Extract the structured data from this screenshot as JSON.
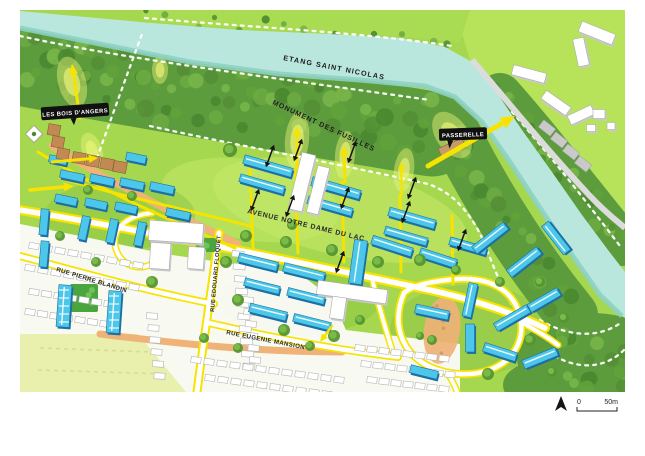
{
  "labels": {
    "lake": "ETANG SAINT NICOLAS",
    "les_bois": "LES BOIS D'ANGERS",
    "monument": "MONUMENT DES FUSILLES",
    "passerelle": "PASSERELLE",
    "avenue": "AVENUE NOTRE DAME DU LAC",
    "rue_blandin": "RUE PIERRE BLANDIN",
    "rue_floquet": "RUE EDOUARD FLOQUET",
    "rue_mansion": "RUE EUGENIE MANSION"
  },
  "scale_bar": {
    "start": "0",
    "end": "50m"
  },
  "icons": {
    "north_arrow": "north-arrow-icon",
    "marker": "map-marker-icon"
  },
  "colors": {
    "water": "#b9e7dd",
    "water_edge": "#8ed2c3",
    "forest": "#5d9c3d",
    "forest_dark": "#4a8830",
    "forest_light": "#78b548",
    "lawn": "#a6d84f",
    "lawn_light": "#c6ea6d",
    "lawn_dark": "#86bf3f",
    "shore": "#a9dc52",
    "road_yellow": "#f6e400",
    "road_white": "#ffffff",
    "path_orange": "#efb277",
    "building_blue": "#4cc7e9",
    "building_blue_dark": "#1d6fa5",
    "building_brown": "#c18a55",
    "building_white": "#ffffff",
    "sketch_gray": "#b4b4b4",
    "field": "#e9efad",
    "glow": "#ecf478",
    "ink": "#161616"
  }
}
